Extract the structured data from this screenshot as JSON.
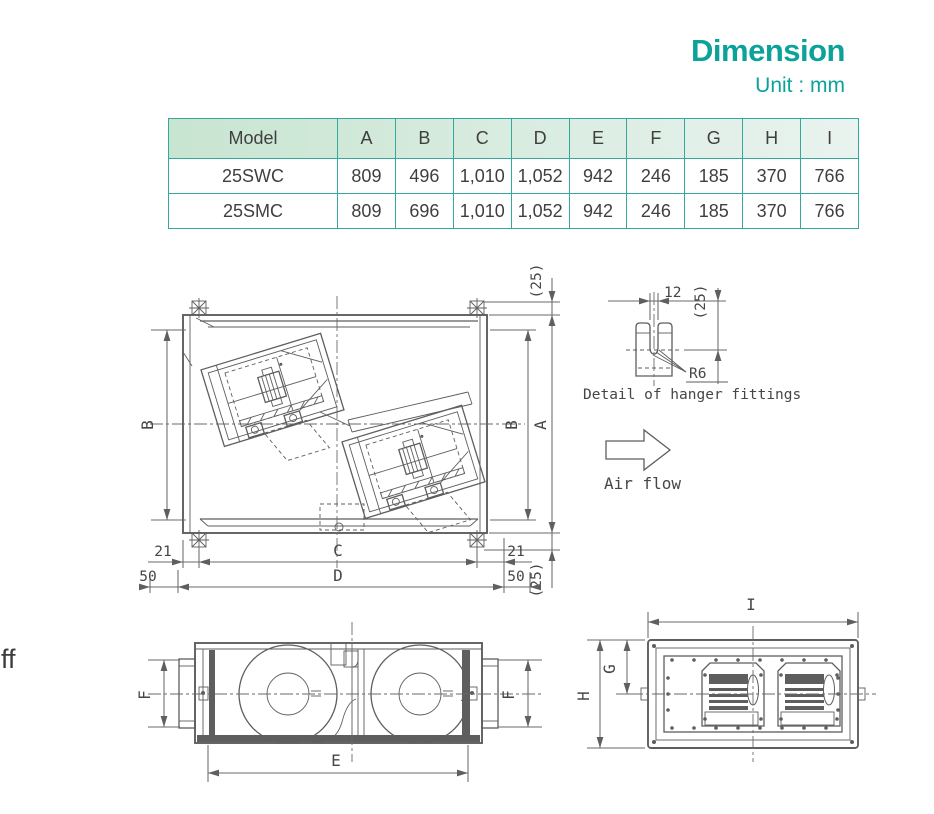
{
  "page": {
    "fragment_text": "ff"
  },
  "header": {
    "title": "Dimension",
    "unit": "Unit : mm",
    "accent_color": "#0ca29a",
    "table_border_color": "#35a79b"
  },
  "table": {
    "headers": [
      "Model",
      "A",
      "B",
      "C",
      "D",
      "E",
      "F",
      "G",
      "H",
      "I"
    ],
    "rows": [
      {
        "cells": [
          "25SWC",
          "809",
          "496",
          "1,010",
          "1,052",
          "942",
          "246",
          "185",
          "370",
          "766"
        ]
      },
      {
        "cells": [
          "25SMC",
          "809",
          "696",
          "1,010",
          "1,052",
          "942",
          "246",
          "185",
          "370",
          "766"
        ]
      }
    ]
  },
  "drawing": {
    "top_view": {
      "dim_b_left": "B",
      "dim_b_right": "B",
      "dim_a": "A",
      "dim_c": "C",
      "dim_d": "D",
      "dim_21_left": "21",
      "dim_21_right": "21",
      "dim_50_left": "50",
      "dim_50_right": "50",
      "dim_25_top": "(25)",
      "dim_25_bottom": "(25)"
    },
    "hanger_detail": {
      "dim_12": "12",
      "dim_25": "(25)",
      "radius": "R6",
      "caption": "Detail of hanger fittings"
    },
    "air_flow": {
      "label": "Air flow"
    },
    "front_view": {
      "dim_e": "E",
      "dim_f_left": "F",
      "dim_f_right": "F"
    },
    "side_view": {
      "dim_i": "I",
      "dim_g": "G",
      "dim_h": "H"
    }
  }
}
